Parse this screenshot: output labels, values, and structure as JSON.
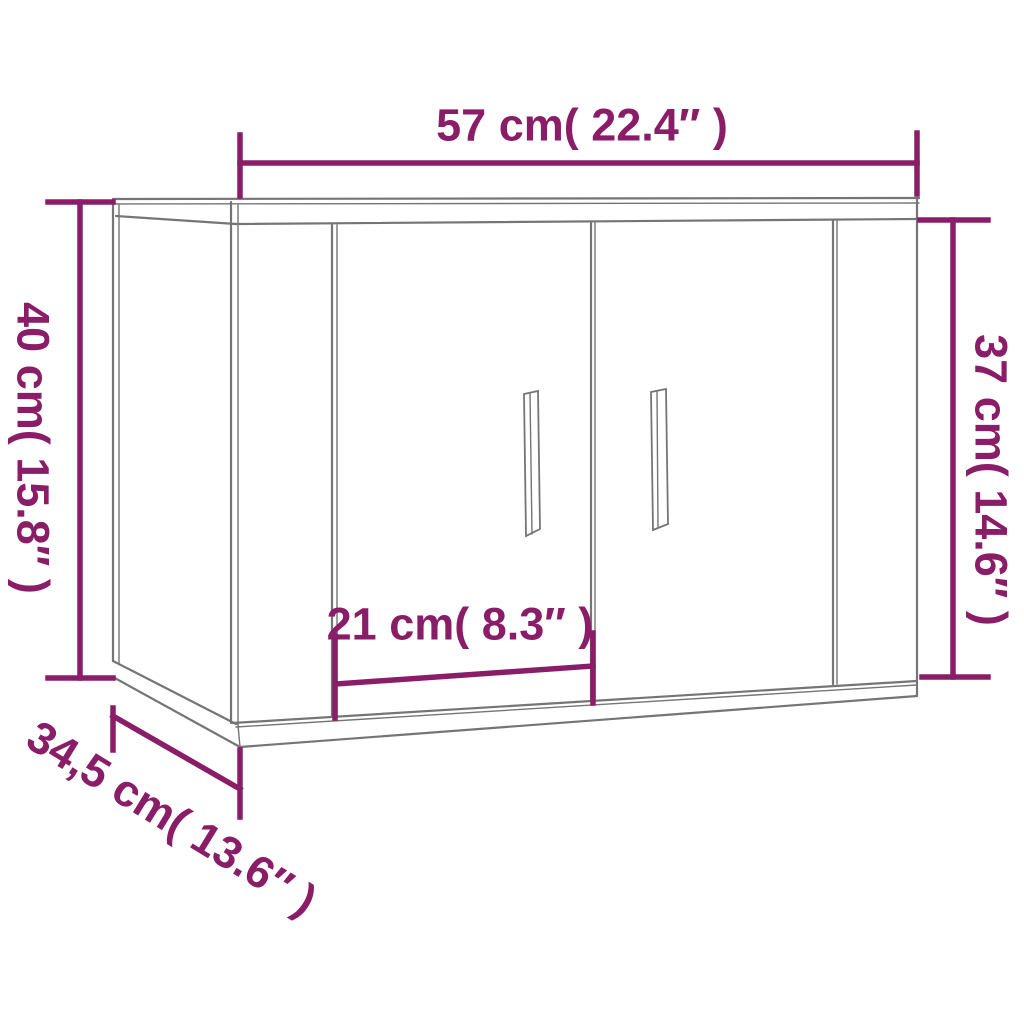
{
  "diagram": {
    "labels": {
      "width_top": "57 cm( 22.4″ )",
      "height_left": "40 cm( 15.8″ )",
      "height_right": "37 cm( 14.6″ )",
      "door_width": "21 cm( 8.3″ )",
      "depth_diagonal": "34,5 cm( 13.6″ )"
    },
    "colors": {
      "dimension_accent": "#8A1D68",
      "outline_gray": "#757575",
      "outline_gray_light": "#9a9a9a",
      "background": "#FFFFFF"
    }
  }
}
